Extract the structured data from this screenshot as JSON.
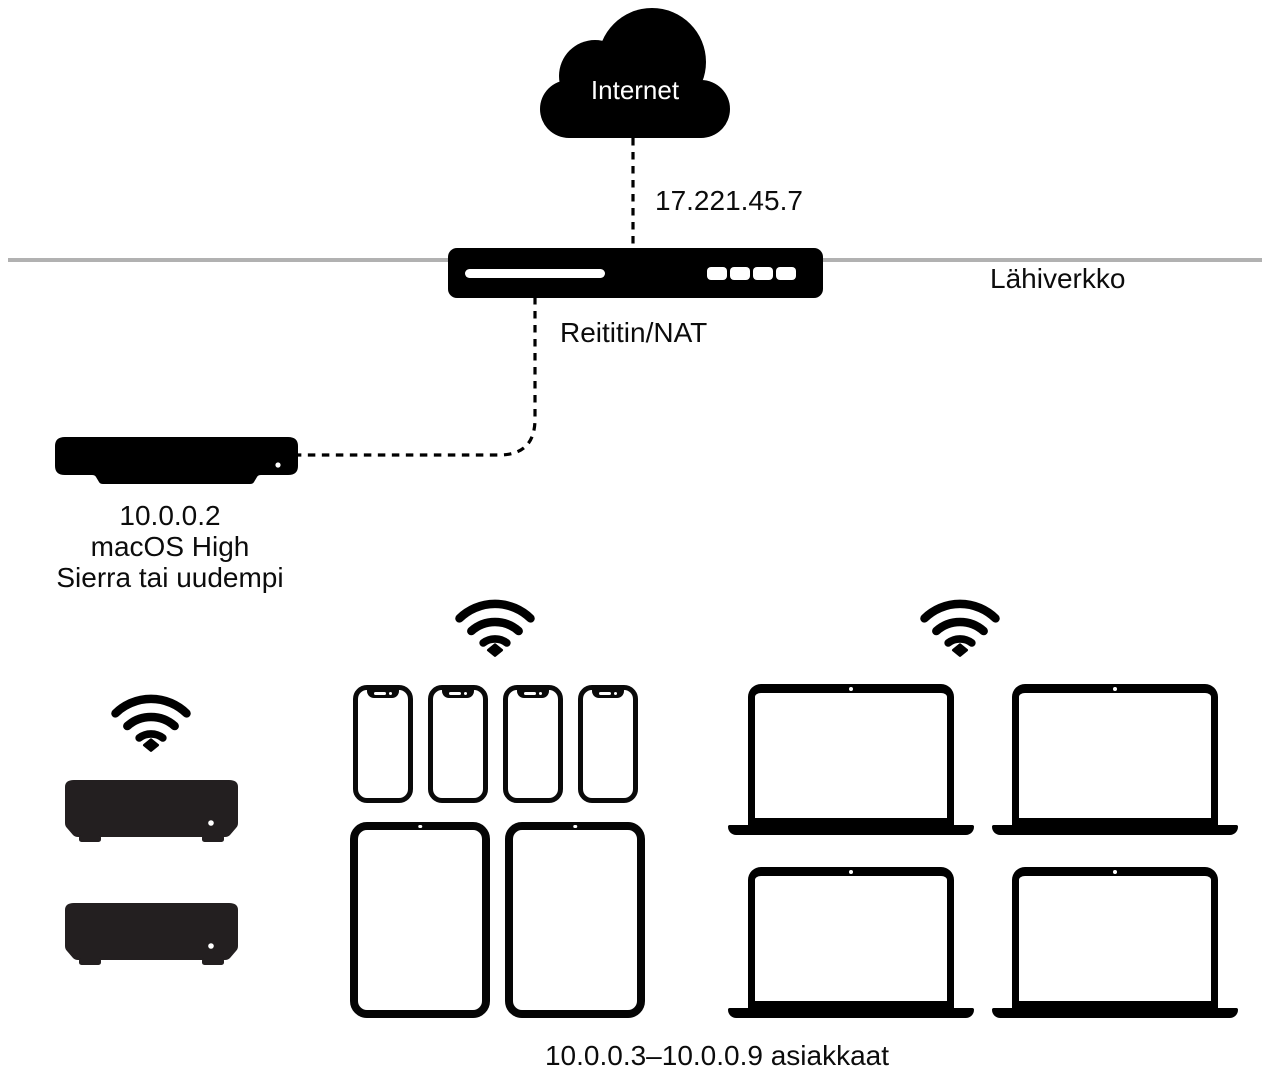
{
  "diagram": {
    "internet": {
      "label": "Internet"
    },
    "wan_ip": "17.221.45.7",
    "router": {
      "label": "Reititin/NAT",
      "port_count": 4
    },
    "lan": {
      "label": "Lähiverkko"
    },
    "server": {
      "ip": "10.0.0.2",
      "os_line1": "macOS High",
      "os_line2": "Sierra tai uudempi"
    },
    "clients": {
      "label": "10.0.0.3–10.0.0.9 asiakkaat",
      "mac_mini_count": 2,
      "iphone_count": 4,
      "ipad_count": 2,
      "macbook_count": 4
    },
    "colors": {
      "device_black": "#000000",
      "mac_mini_charcoal": "#231f20",
      "lan_line_gray": "#b1b1b1",
      "background": "#ffffff",
      "label_text": "#0c0c0c"
    }
  }
}
